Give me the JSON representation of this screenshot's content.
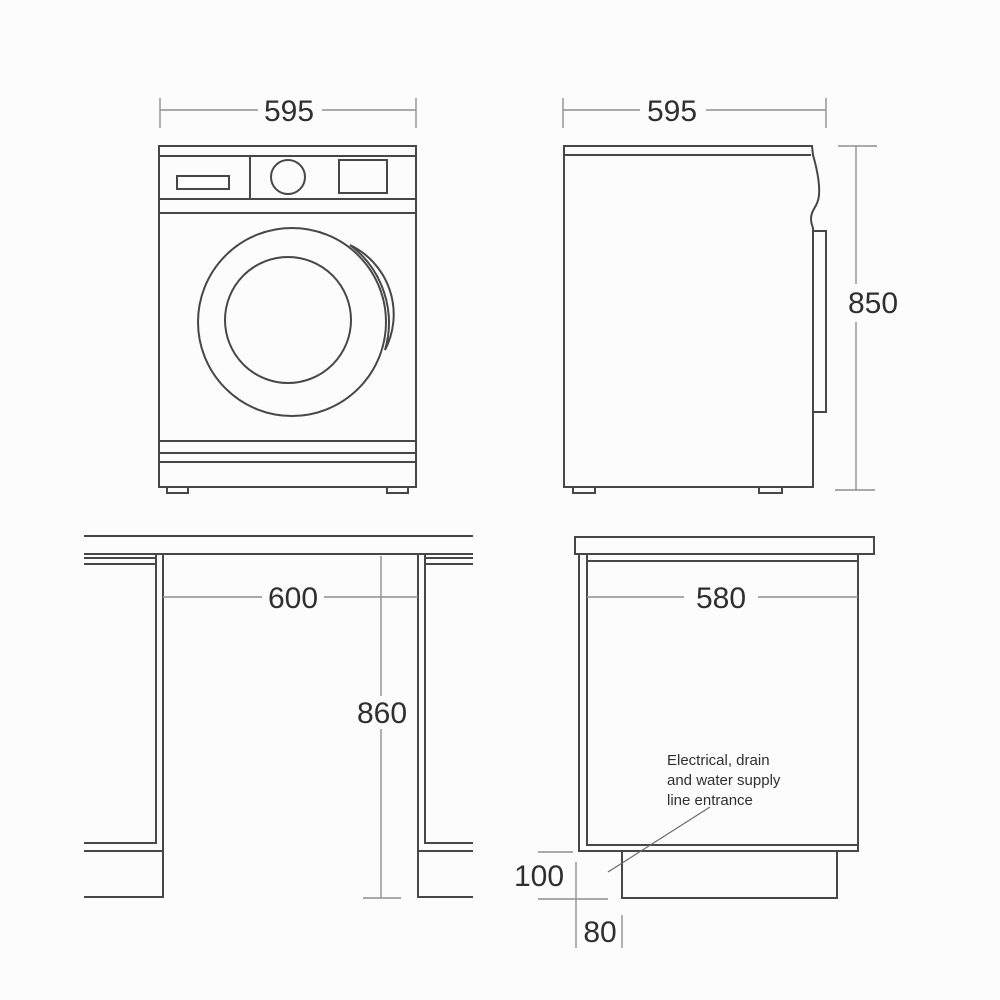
{
  "colors": {
    "background": "#fcfcfc",
    "object_line": "#474747",
    "dimension_line": "#8f8f8f",
    "text": "#2f2f2f"
  },
  "dims": {
    "front_width": "595",
    "side_depth": "595",
    "side_height": "850",
    "niche_width": "600",
    "niche_height": "860",
    "cutout_depth": "580",
    "plinth_height": "100",
    "plinth_recess": "80"
  },
  "note": {
    "line1": "Electrical, drain",
    "line2": "and water supply",
    "line3": "line entrance"
  }
}
